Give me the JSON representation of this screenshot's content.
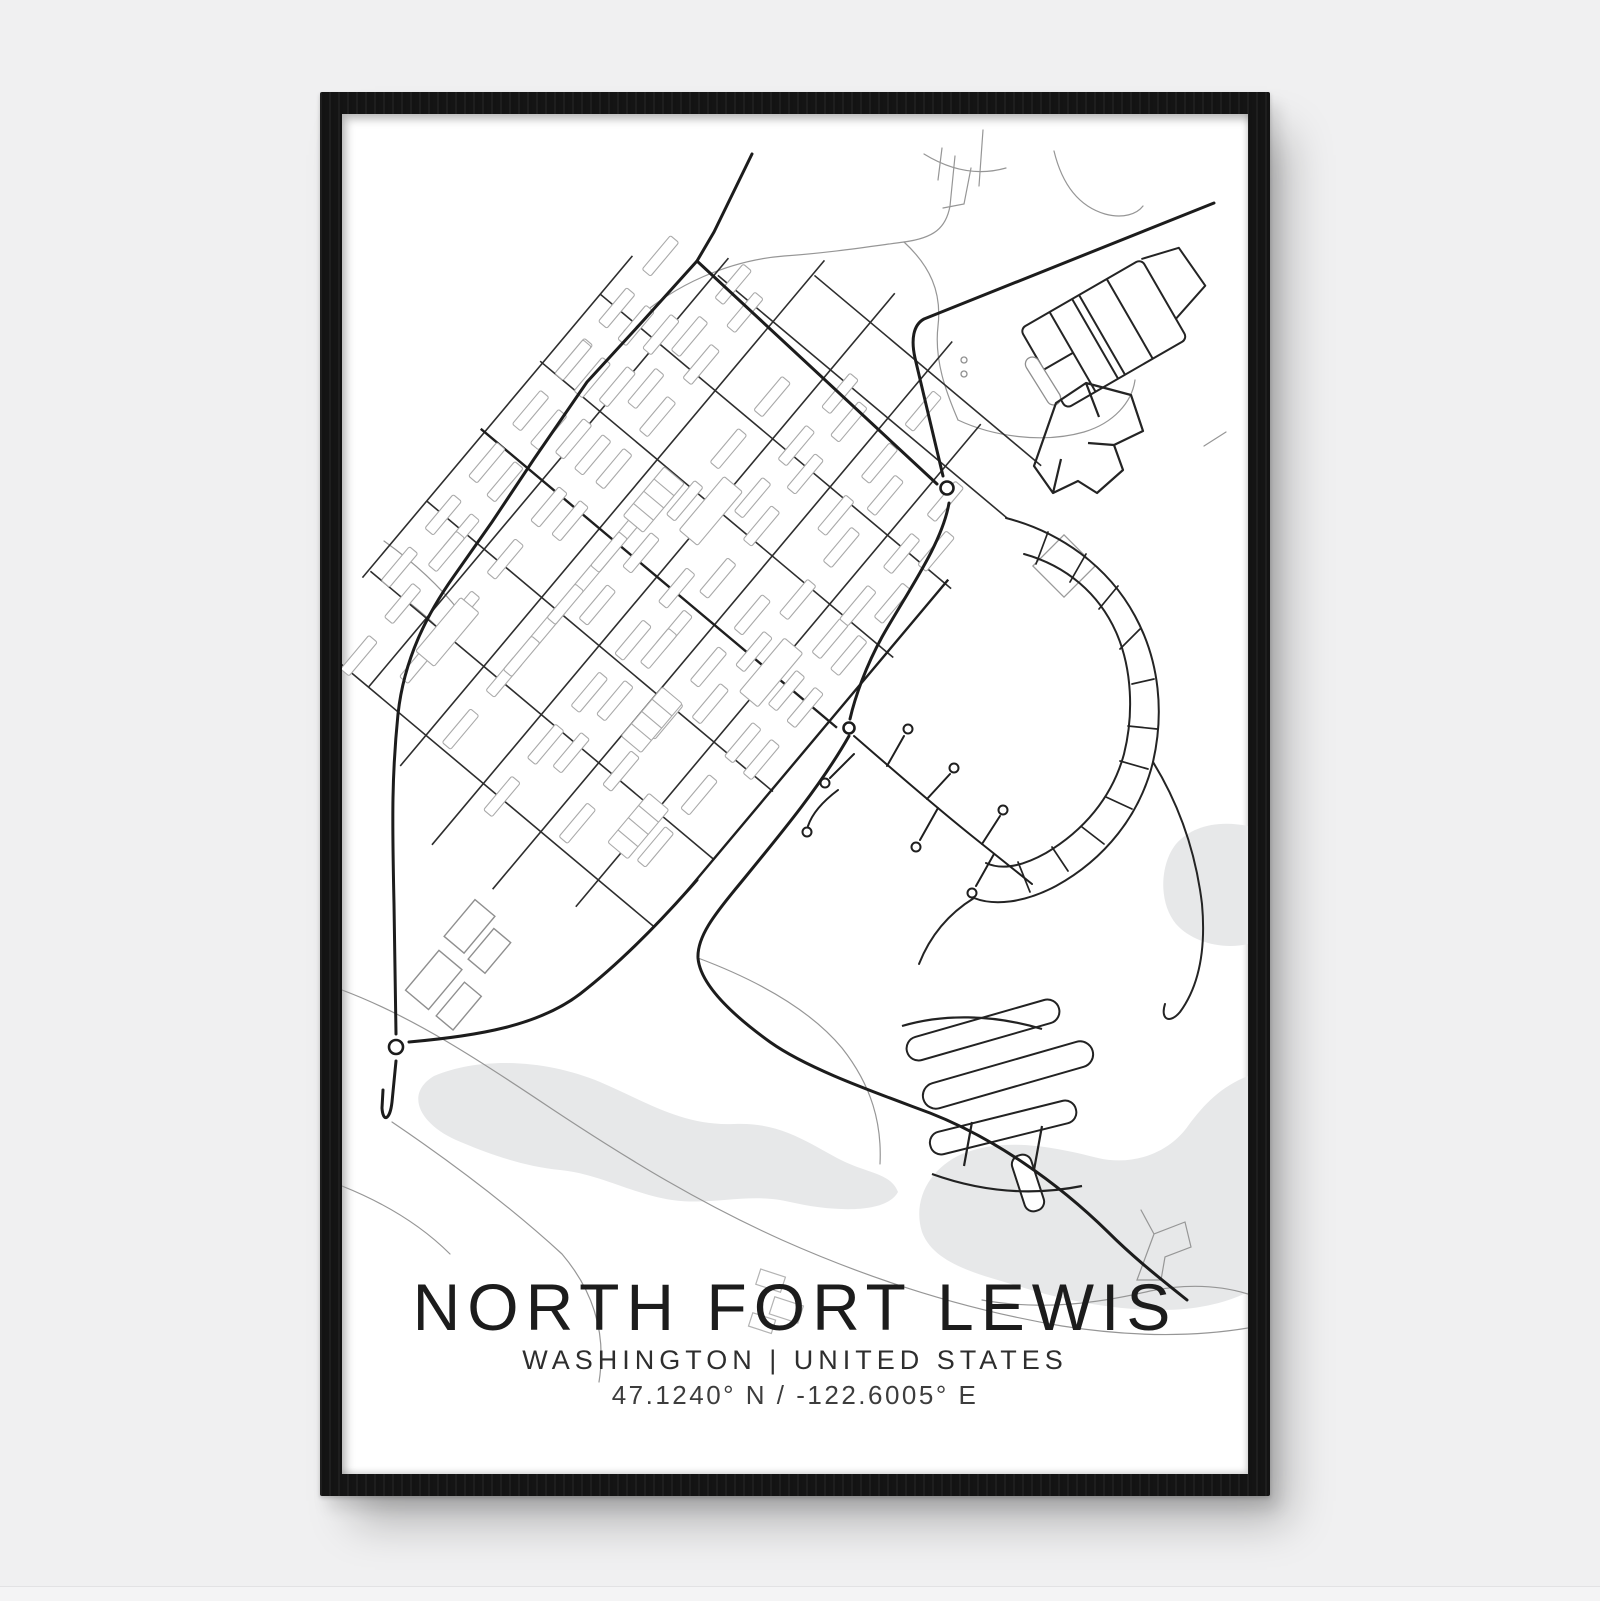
{
  "poster": {
    "title": "NORTH FORT LEWIS",
    "region": "WASHINGTON | UNITED STATES",
    "coordinates": "47.1240° N / -122.6005° E",
    "map_style": "minimal black-and-white street map",
    "frame_style": "black wood frame"
  },
  "colors": {
    "backdrop": "#f0f0f1",
    "frame": "#141414",
    "paper": "#ffffff",
    "major_road": "#1c1c1c",
    "grid_road": "#2e2e2e",
    "minor_road": "#969696",
    "building_outline": "#a9a9a9",
    "water": "#e7e8e9",
    "title_ink": "#1c1c1c"
  }
}
